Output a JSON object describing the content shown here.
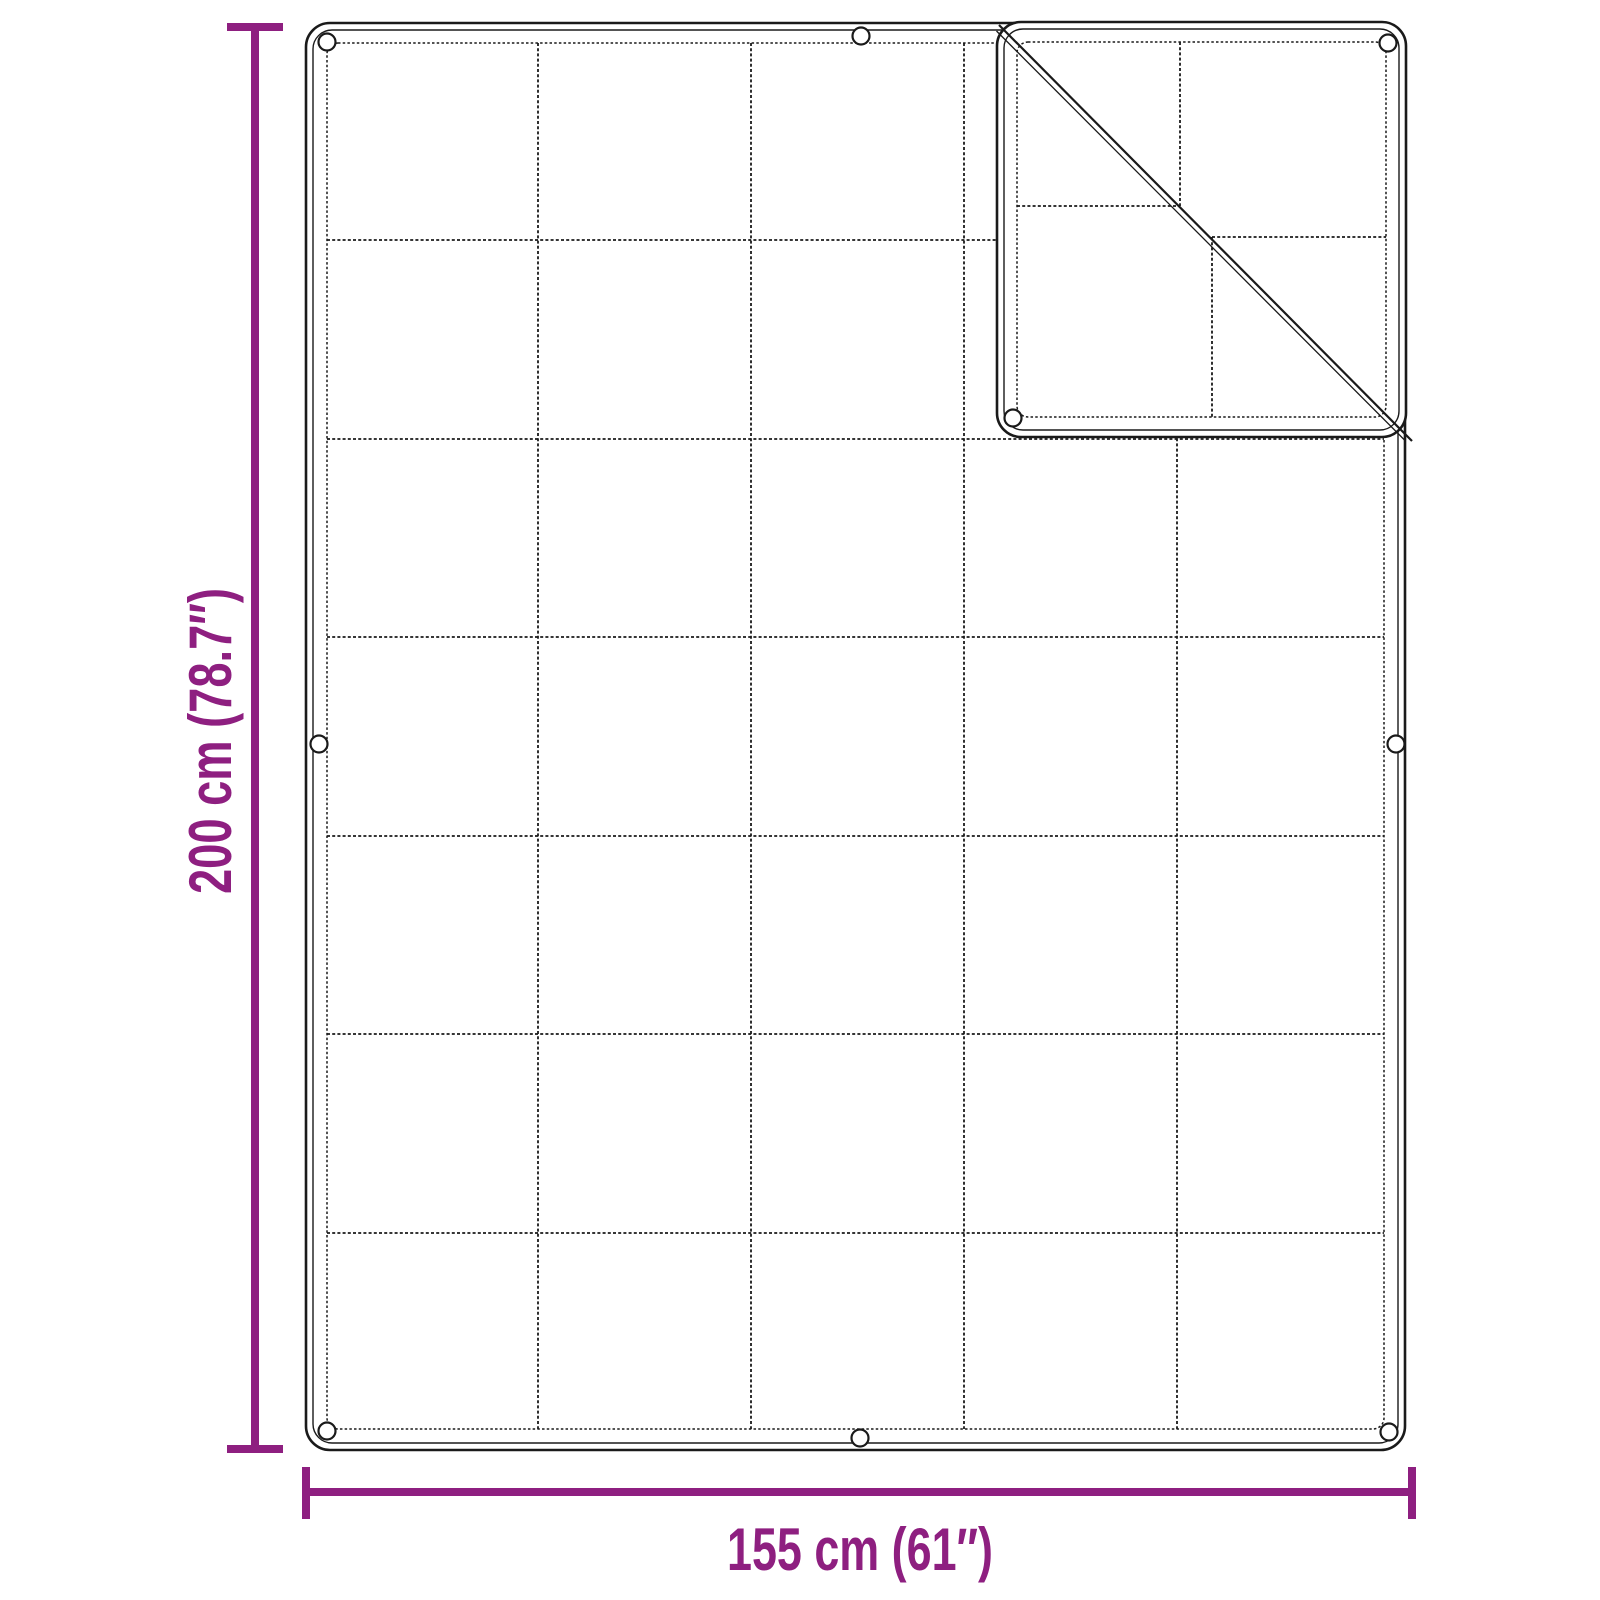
{
  "diagram": {
    "subject": "blanket-tarp-with-grid-pattern-and-folded-corner",
    "height_label": "200 cm (78.7″)",
    "width_label": "155 cm (61″)",
    "dimensions": {
      "height_cm": 200,
      "height_in": 78.7,
      "width_cm": 155,
      "width_in": 61
    },
    "grid": {
      "columns": 5,
      "rows": 7
    },
    "grommets_visible": 9,
    "colors": {
      "accent": "#8E1F80",
      "line": "#1A1A1A",
      "background": "#FFFFFF"
    }
  }
}
